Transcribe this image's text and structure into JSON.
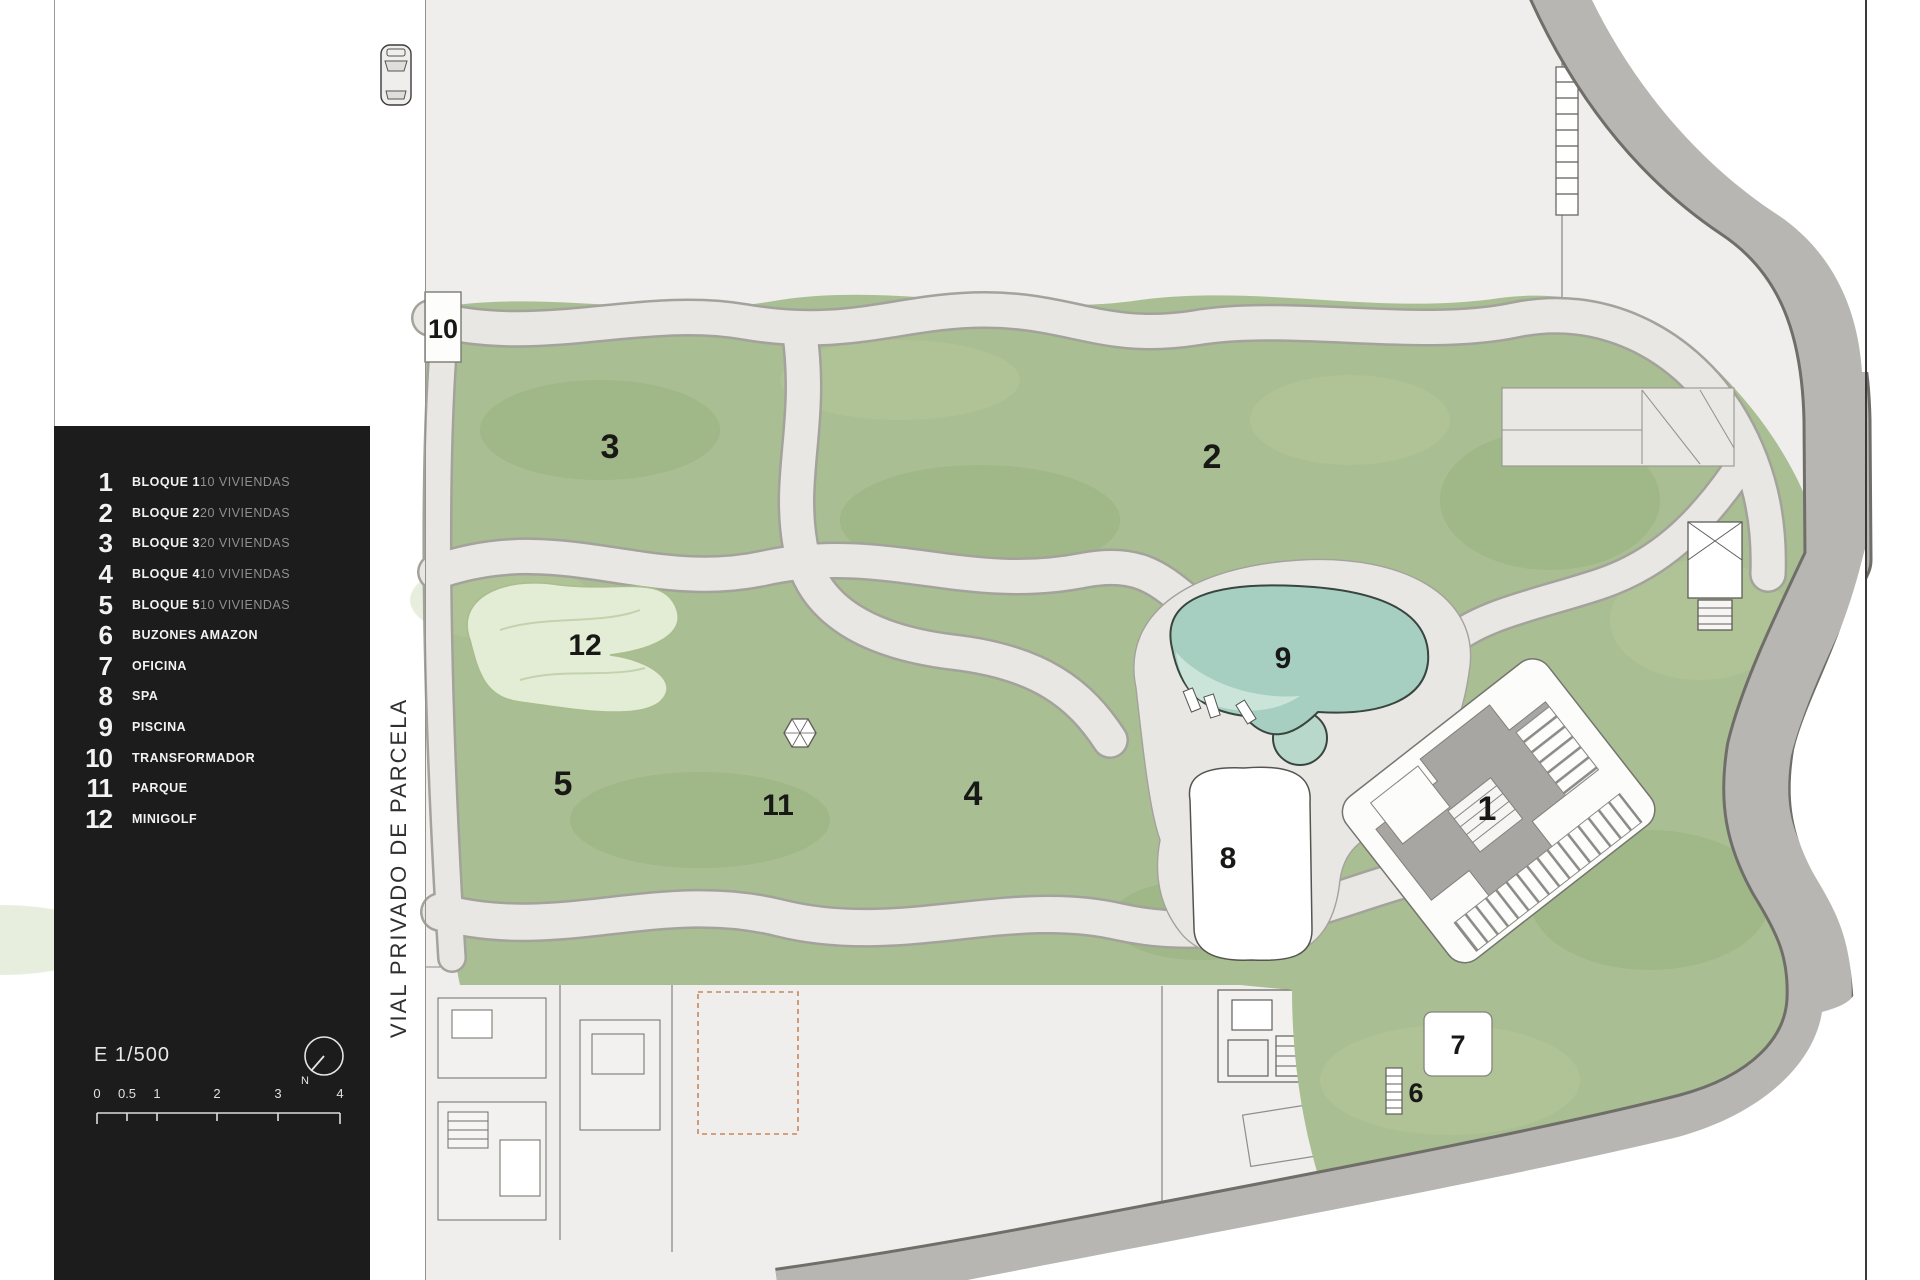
{
  "legend": {
    "items": [
      {
        "num": "1",
        "label": "BLOQUE 1",
        "detail": "10 VIVIENDAS"
      },
      {
        "num": "2",
        "label": "BLOQUE 2",
        "detail": "20 VIVIENDAS"
      },
      {
        "num": "3",
        "label": "BLOQUE 3",
        "detail": "20 VIVIENDAS"
      },
      {
        "num": "4",
        "label": "BLOQUE 4",
        "detail": "10 VIVIENDAS"
      },
      {
        "num": "5",
        "label": "BLOQUE 5",
        "detail": "10 VIVIENDAS"
      },
      {
        "num": "6",
        "label": "BUZONES AMAZON",
        "detail": ""
      },
      {
        "num": "7",
        "label": "OFICINA",
        "detail": ""
      },
      {
        "num": "8",
        "label": "SPA",
        "detail": ""
      },
      {
        "num": "9",
        "label": "PISCINA",
        "detail": ""
      },
      {
        "num": "10",
        "label": "TRANSFORMADOR",
        "detail": ""
      },
      {
        "num": "11",
        "label": "PARQUE",
        "detail": ""
      },
      {
        "num": "12",
        "label": "MINIGOLF",
        "detail": ""
      }
    ],
    "scale_label": "E 1/500",
    "north_label": "N",
    "scale_ticks": [
      "0",
      "0.5",
      "1",
      "2",
      "3",
      "4"
    ]
  },
  "plan": {
    "street_label": "VIAL PRIVADO DE PARCELA",
    "labels": {
      "block1": "1",
      "block2": "2",
      "block3": "3",
      "block4": "4",
      "block5": "5",
      "buzones": "6",
      "oficina": "7",
      "spa": "8",
      "piscina": "9",
      "transformador": "10",
      "parque": "11",
      "minigolf": "12"
    }
  },
  "colors": {
    "legend_bg": "#1c1c1c",
    "garden": "#a9be92",
    "pool_water": "#a6cfc1",
    "road": "#b7b6b2",
    "path": "#e8e7e4",
    "plot_dashed_accent": "#c8875b"
  }
}
